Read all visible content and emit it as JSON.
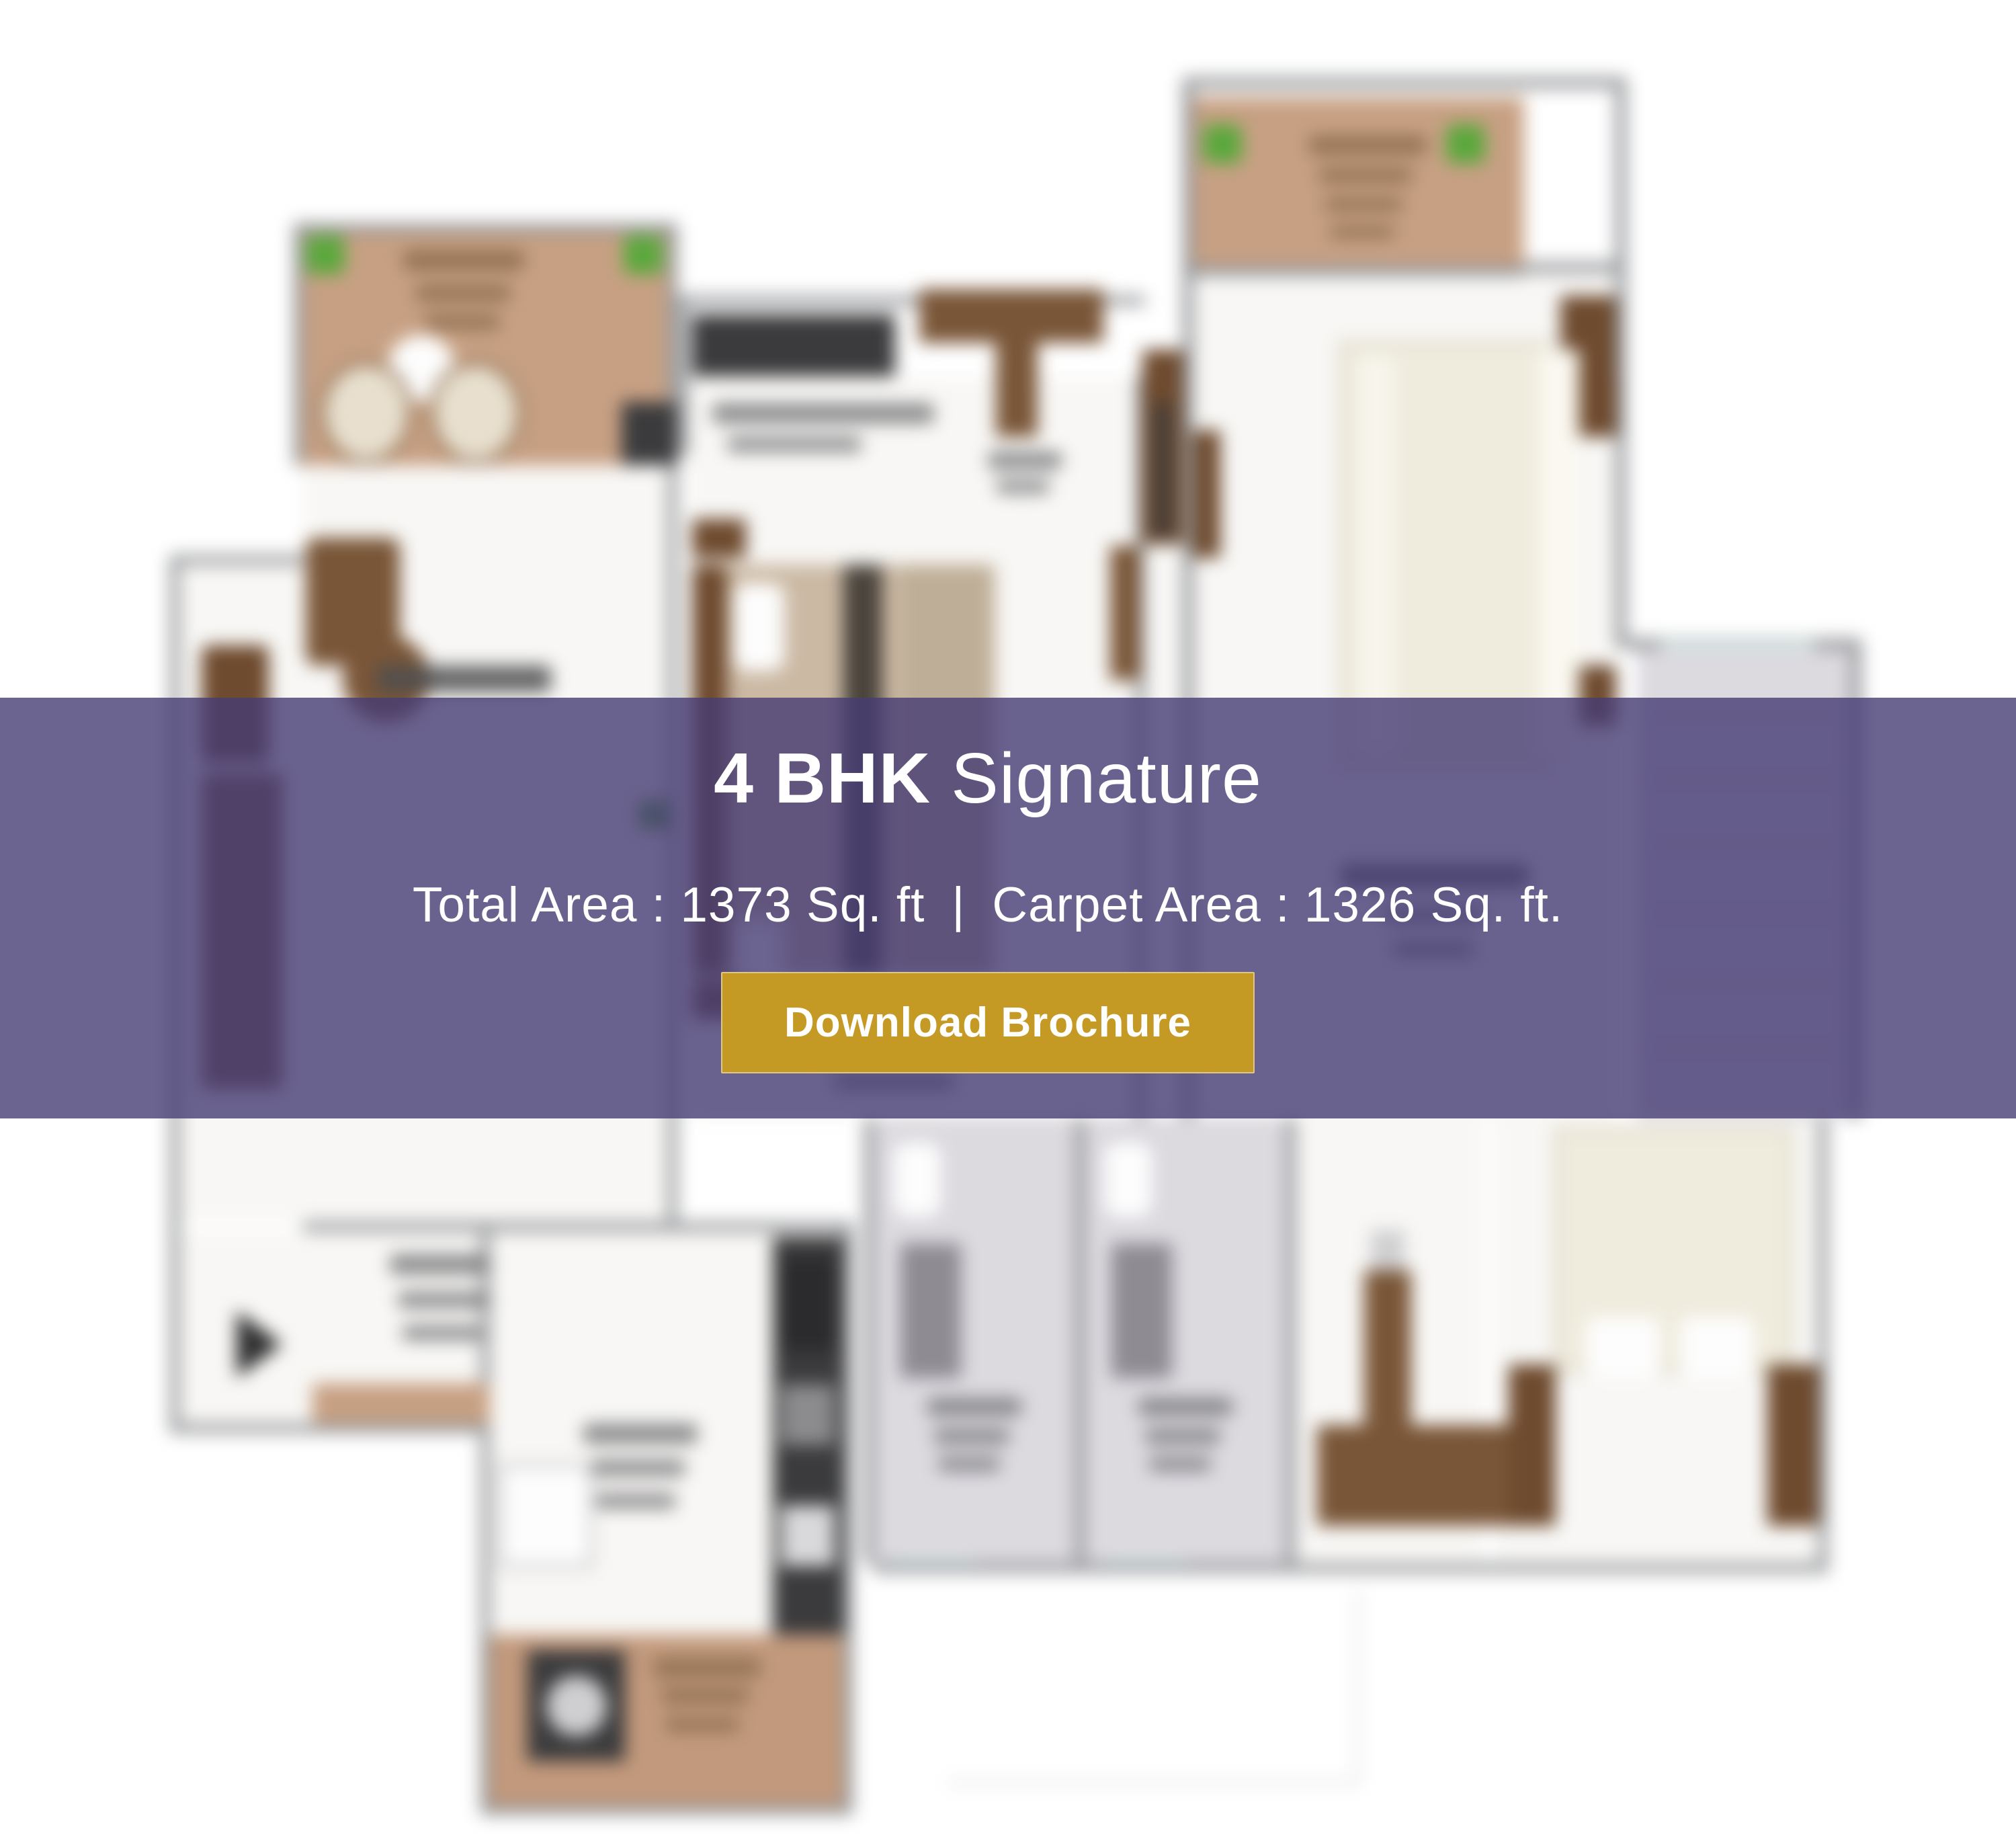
{
  "overlay": {
    "title": {
      "bold": "4 BHK",
      "regular": "Signature"
    },
    "subtitle": {
      "total": "Total Area : 1373 Sq. ft",
      "separator": "|",
      "carpet": "Carpet Area : 1326 Sq. ft."
    },
    "button": {
      "label": "Download Brochure"
    }
  },
  "colors": {
    "band": "rgba(70,60,116,0.8)",
    "button_gold": "#C49A25",
    "balcony_tan": "#C7A083",
    "utility_tan": "#C2997C",
    "plant_green": "#5AA83C",
    "wall_grey": "#96989B",
    "furniture_brown": "#7A5638",
    "dark_brown": "#6E4A2E",
    "dark_counter": "#3B3B3D",
    "tile_grey": "#DCD9DF",
    "tile_line": "#C8C4CD",
    "bed_cream": "#EFEBDD",
    "window_cyan": "#D9EDEC",
    "floor_white": "#F8F7F5",
    "label_dark": "#4E4E50",
    "label_grey": "#6F6F72",
    "smudge_tan": "#8A6A4C",
    "arrow_black": "#2F2F30"
  },
  "floor_plan": {
    "regions": [
      "balcony",
      "living-room",
      "lobby",
      "kitchen",
      "utility",
      "bedroom-1",
      "master-bedroom",
      "master-balcony",
      "staircase-area",
      "toilet-1",
      "toilet-2",
      "bedroom-2"
    ]
  }
}
